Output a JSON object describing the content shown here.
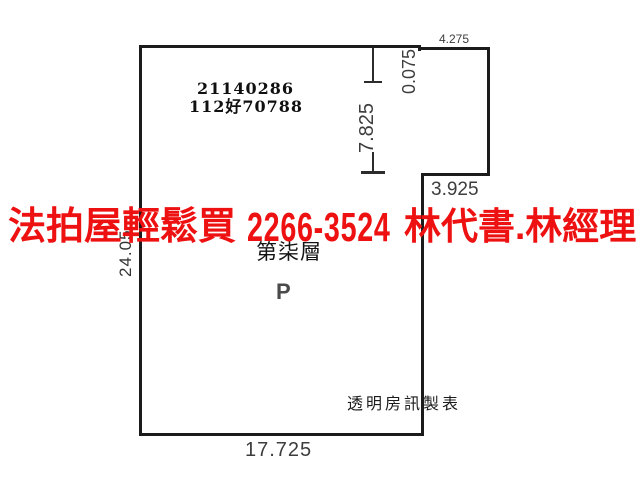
{
  "background_color": "#ffffff",
  "plan": {
    "case_number_line1": "21140286",
    "case_number_line2": "112好70788",
    "floor_label": "第柒層",
    "space_label": "P",
    "maker_label": "透明房訊製表",
    "line_color": "#1b1b1b",
    "dim_text_color": "#3d3d3d",
    "dimensions": {
      "top_right_width": "4.275",
      "top_notch_depth": "0.075",
      "upper_right_height": "7.825",
      "right_step_width": "3.925",
      "left_height": "24.05",
      "bottom_width": "17.725"
    }
  },
  "overlay": {
    "agency_text": "法拍屋輕鬆買",
    "phone_number": "2266-3524",
    "contact_text": "林代書.林經理",
    "color": "#ee1111"
  }
}
